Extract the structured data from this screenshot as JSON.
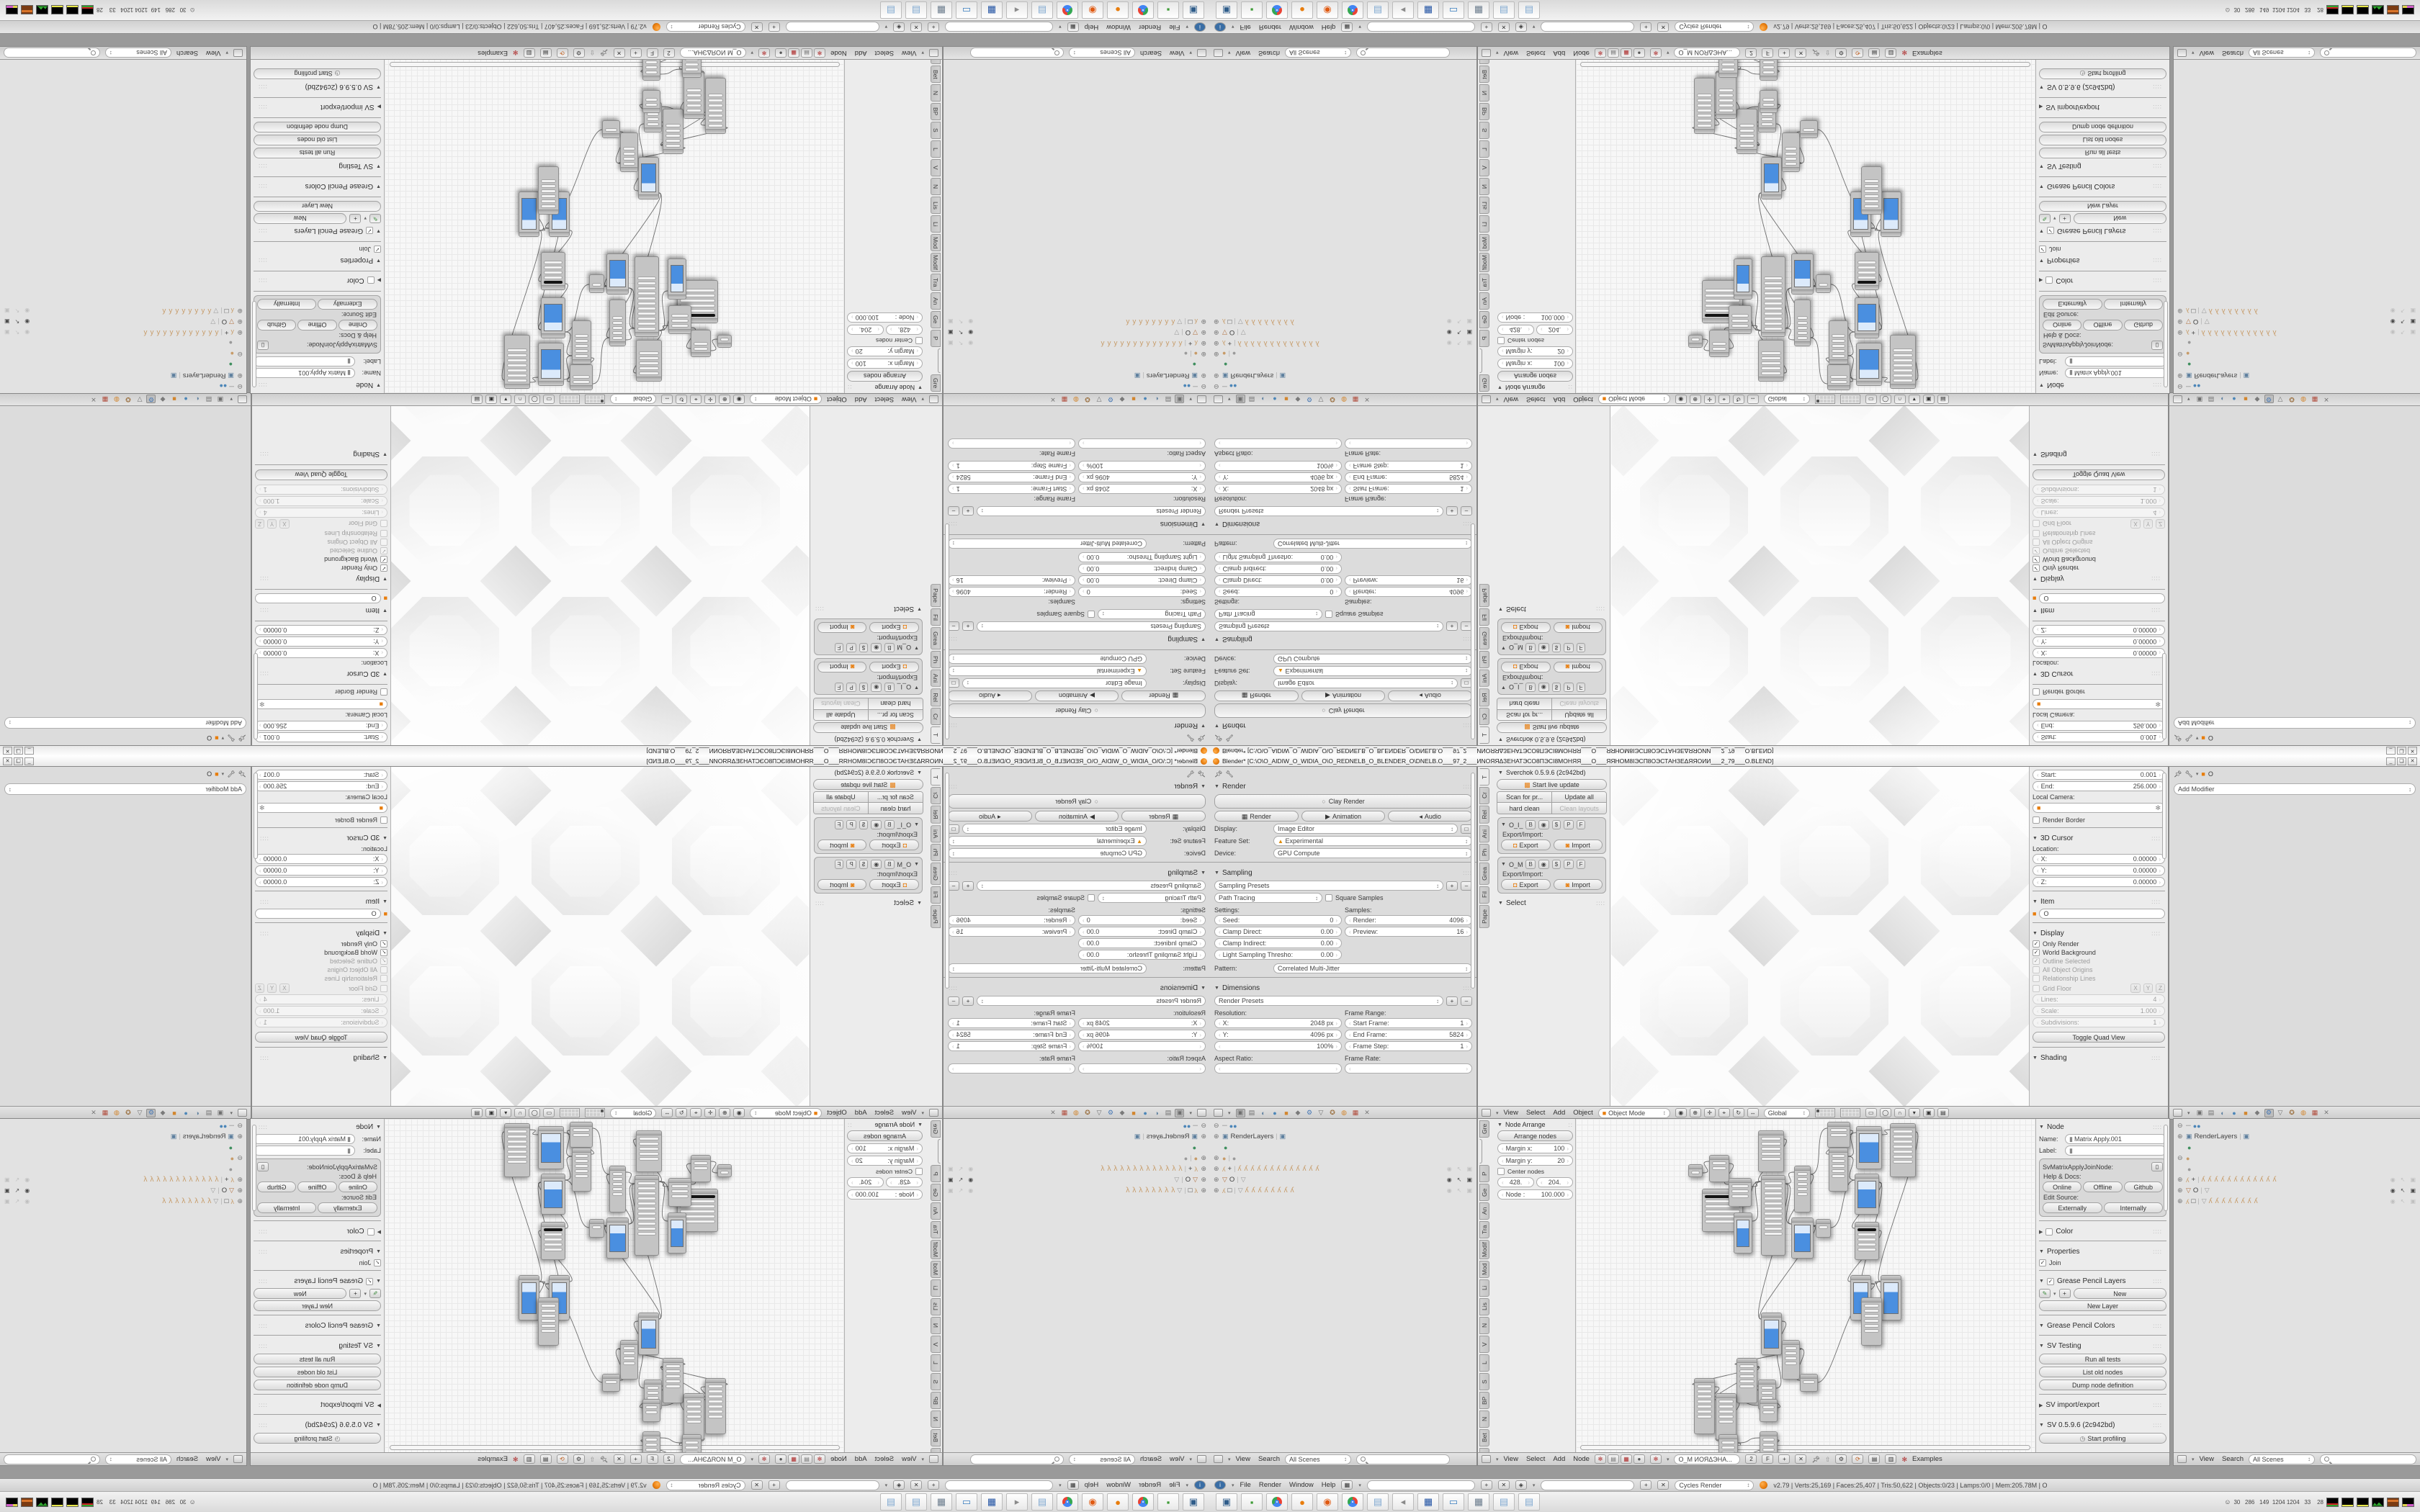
{
  "window": {
    "title": "Blender* [C:\\O\\O_AIDIW_O_WIDIA_O\\O_REDNELB_O_BLENDER_O\\DNELB.O___97_2___ИNOЯЯΔЗЕНАТЭСО8ПЭСІ8МОНЯЯ___O___ЯЯНОМ8ІЭСП8ОЭСТАНЗЕΔЯЯОИИ___2_79___O.BLEND]",
    "controls": {
      "min": "_",
      "restore": "❏",
      "close": "✕"
    }
  },
  "props_render": {
    "panel_render": "Render",
    "clay": "Clay Render",
    "render": "Render",
    "animation": "Animation",
    "audio": "Audio",
    "display_l": "Display:",
    "display_v": "Image Editor",
    "feature_l": "Feature Set:",
    "feature_v": "Experimental",
    "device_l": "Device:",
    "device_v": "GPU Compute",
    "panel_sampling": "Sampling",
    "presets": "Sampling Presets",
    "integrator": "Path Tracing",
    "square": "Square Samples",
    "settings_l": "Settings:",
    "samples_l": "Samples:",
    "seed_l": "Seed:",
    "seed_v": "0",
    "render_s_l": "Render:",
    "render_s_v": "4096",
    "clampd_l": "Clamp Direct:",
    "clampd_v": "0.00",
    "preview_l": "Preview:",
    "preview_v": "16",
    "clampi_l": "Clamp Indirect:",
    "clampi_v": "0.00",
    "light_l": "Light Sampling Thresho:",
    "light_v": "0.00",
    "pattern_l": "Pattern:",
    "pattern_v": "Correlated Multi-Jitter",
    "panel_dim": "Dimensions",
    "dim_presets": "Render Presets",
    "res_l": "Resolution:",
    "frame_l": "Frame Range:",
    "x_l": "X:",
    "x_v": "2048 px",
    "sf_l": "Start Frame:",
    "sf_v": "1",
    "y_l": "Y:",
    "y_v": "4096 px",
    "ef_l": "End Frame:",
    "ef_v": "5824",
    "pct": "100%",
    "fs_l": "Frame Step:",
    "fs_v": "1",
    "aspect_l": "Aspect Ratio:",
    "rate_l": "Frame Rate:"
  },
  "sv_shelf": {
    "tabs": [
      "T",
      "Cr",
      "Rel",
      "Ani",
      "Ph",
      "Grea",
      "Fil",
      "Pape"
    ],
    "title": "Sverchok 0.5.9.6 (2c942bd)",
    "live": "Start live update",
    "grid": [
      "Scan for pr...",
      "Update all",
      "hard clean",
      "Clean layouts"
    ],
    "g1": "O_I_",
    "g2": "O_M",
    "bB": "B",
    "bP": "P",
    "bF": "F",
    "ei": "Export/Import:",
    "exp": "Export",
    "imp": "Import",
    "select": "Select"
  },
  "vp_header": {
    "m1": "View",
    "m2": "Select",
    "m3": "Add",
    "m4": "Object",
    "mode": "Object Mode",
    "orient": "Global",
    "icons": [
      "◉",
      "⊕",
      "✛",
      "⌖",
      "↻",
      "↔"
    ],
    "tail_icons": [
      "▭",
      "◯",
      "∩",
      "▾",
      "▣",
      "▤"
    ]
  },
  "vp_npanel": {
    "start_l": "Start:",
    "start_v": "0.001",
    "end_l": "End:",
    "end_v": "256.000",
    "cam_l": "Local Camera:",
    "border": "Render Border",
    "cursor": "3D Cursor",
    "loc_l": "Location:",
    "x": "X:",
    "xv": "0.00000",
    "y": "Y:",
    "yv": "0.00000",
    "z": "Z:",
    "zv": "0.00000",
    "item": "Item",
    "item_name": "O",
    "display": "Display",
    "only": "Only Render",
    "world": "World Background",
    "outline": "Outline Selected",
    "origins": "All Object Origins",
    "rel": "Relationship Lines",
    "grid": "Grid Floor",
    "gx": "X",
    "gy": "Y",
    "gz": "Z",
    "lines_l": "Lines:",
    "lines_v": "4",
    "scale_l": "Scale:",
    "scale_v": "1.000",
    "subd_l": "Subdivisions:",
    "subd_v": "1",
    "quadview": "Toggle Quad View",
    "shading": "Shading"
  },
  "props_mod": {
    "add": "Add Modifier",
    "crumb": "O"
  },
  "props_tabs": {
    "icons": [
      "▣",
      "▤",
      "◐",
      "●",
      "■",
      "◆",
      "⚙",
      "▽",
      "✪",
      "◍",
      "▦",
      "✕"
    ],
    "colors": [
      "#6f6f6f",
      "#6f6f6f",
      "#5d7f9e",
      "#4c86b8",
      "#d2862e",
      "#7a7a7a",
      "#4a7ab5",
      "#6f6f6f",
      "#9a6f3f",
      "#d2862e",
      "#b04a3a",
      "#7a7a7a"
    ],
    "active_a": 0,
    "active_b": 6
  },
  "outliner": {
    "header": {
      "view": "View",
      "search": "Search",
      "scenes": "All Scenes"
    },
    "a_rows": [
      {
        "type": "root"
      },
      {
        "exp": "⊕",
        "icon": "layers",
        "label": "RenderLayers",
        "extra": "layers"
      },
      {
        "icon": "world",
        "indent": 1
      },
      {
        "exp": "⊕",
        "icon": "blob",
        "extra": "blobg"
      },
      {
        "exp": "⊕",
        "icon": "bone",
        "label": "+",
        "bones": 13,
        "tog": "dim"
      },
      {
        "exp": "⊕",
        "icon": "tri",
        "label": "O",
        "extra": "trig",
        "tog": "on"
      },
      {
        "exp": "⊕",
        "icon": "bone",
        "label": "□",
        "tri": true,
        "bones": 8,
        "tog": "dim"
      }
    ],
    "b_rows": [
      {
        "type": "root"
      },
      {
        "exp": "⊕",
        "icon": "layers",
        "label": "RenderLayers",
        "extra": "layers"
      },
      {
        "icon": "world",
        "indent": 1
      },
      {
        "exp": "⊖",
        "icon": "blob"
      },
      {
        "icon": "blobg",
        "indent": 1
      },
      {
        "exp": "⊕",
        "icon": "bone",
        "label": "+",
        "bones": 12,
        "tog": "dim"
      },
      {
        "exp": "⊕",
        "icon": "tri",
        "label": "O",
        "extra": "trig",
        "tog": "on"
      },
      {
        "exp": "⊕",
        "icon": "bone",
        "label": "□",
        "tri": true,
        "bones": 8,
        "tog": "dim"
      }
    ]
  },
  "node_shelf": {
    "tabs": [
      "Gre",
      "",
      "P",
      "Ge",
      "An",
      "Tra",
      "Modif",
      "Mod",
      "Li",
      "Lis",
      "N",
      "V",
      "L",
      "S",
      "BP",
      "N",
      "Bet",
      "G"
    ],
    "title": "Node Arrange",
    "arrange": "Arrange nodes",
    "mx": "Margin x:",
    "mxv": "100",
    "my": "Margin y:",
    "myv": "20",
    "center": "Center nodes",
    "fa": "428.",
    "fb": "204.",
    "fn_l": "Node :",
    "fn_v": "100.000"
  },
  "node_header": {
    "m1": "View",
    "m2": "Select",
    "m3": "Add",
    "m4": "Node",
    "db": "O_M ИОЯΔЭНА...",
    "users": "2",
    "fake": "F",
    "examples": "Examples"
  },
  "node_npanel": {
    "title": "Node",
    "name_l": "Name:",
    "name_v": "Matrix Apply.001",
    "label_l": "Label:",
    "idname": "SvMatrixApplyJoinNode:",
    "help": "Help & Docs:",
    "h1": "Online",
    "h2": "Offline",
    "h3": "Github",
    "edit": "Edit Source:",
    "e1": "Externally",
    "e2": "Internally",
    "color": "Color",
    "properties": "Properties",
    "join": "Join",
    "gp_layers": "Grease Pencil Layers",
    "new": "New",
    "new_layer": "New Layer",
    "gp_colors": "Grease Pencil Colors",
    "sv_testing": "SV Testing",
    "t1": "Run all tests",
    "t2": "List old nodes",
    "t3": "Dump node definition",
    "sv_ie": "SV import/export",
    "sv_ver": "SV 0.5.9.6 (2c942bd)",
    "profiling": "Start profiling"
  },
  "node_editor": {
    "nodes": [
      [
        156,
        63,
        20,
        18,
        0
      ],
      [
        185,
        50,
        28,
        38,
        0
      ],
      [
        175,
        97,
        57,
        60,
        2
      ],
      [
        212,
        82,
        32,
        40,
        0
      ],
      [
        219,
        130,
        26,
        57,
        1
      ],
      [
        253,
        16,
        36,
        58,
        0
      ],
      [
        257,
        78,
        34,
        112,
        0
      ],
      [
        303,
        65,
        23,
        65,
        0
      ],
      [
        299,
        137,
        31,
        57,
        1
      ],
      [
        333,
        139,
        21,
        26,
        0
      ],
      [
        349,
        4,
        32,
        36,
        0
      ],
      [
        351,
        40,
        27,
        61,
        0
      ],
      [
        389,
        10,
        36,
        60,
        1
      ],
      [
        436,
        6,
        36,
        75,
        0
      ],
      [
        387,
        76,
        34,
        57,
        1
      ],
      [
        387,
        143,
        34,
        53,
        2
      ],
      [
        381,
        217,
        29,
        63,
        1
      ],
      [
        423,
        217,
        29,
        63,
        1
      ],
      [
        396,
        248,
        29,
        67,
        0
      ],
      [
        257,
        269,
        29,
        59,
        1
      ],
      [
        286,
        307,
        25,
        55,
        0
      ],
      [
        311,
        354,
        25,
        25,
        0
      ],
      [
        223,
        332,
        29,
        63,
        0
      ],
      [
        253,
        362,
        25,
        42,
        0
      ],
      [
        164,
        360,
        29,
        78,
        0
      ],
      [
        194,
        381,
        29,
        65,
        0
      ],
      [
        255,
        389,
        25,
        32,
        0
      ],
      [
        198,
        438,
        27,
        42,
        0
      ],
      [
        255,
        434,
        25,
        42,
        0
      ],
      [
        198,
        478,
        27,
        38,
        0
      ],
      [
        255,
        474,
        25,
        40,
        1
      ]
    ],
    "wires": [
      [
        0,
        1
      ],
      [
        1,
        3
      ],
      [
        2,
        6
      ],
      [
        3,
        6
      ],
      [
        4,
        6
      ],
      [
        5,
        6
      ],
      [
        6,
        7
      ],
      [
        6,
        8
      ],
      [
        7,
        8
      ],
      [
        7,
        10
      ],
      [
        10,
        11
      ],
      [
        11,
        12
      ],
      [
        11,
        14
      ],
      [
        13,
        17
      ],
      [
        14,
        15
      ],
      [
        15,
        16
      ],
      [
        16,
        17
      ],
      [
        14,
        18
      ],
      [
        18,
        17
      ],
      [
        8,
        9
      ],
      [
        8,
        19
      ],
      [
        9,
        14
      ],
      [
        19,
        20
      ],
      [
        20,
        21
      ],
      [
        20,
        22
      ],
      [
        22,
        24
      ],
      [
        23,
        20
      ],
      [
        24,
        25
      ],
      [
        25,
        26
      ],
      [
        25,
        27
      ],
      [
        27,
        28
      ],
      [
        27,
        29
      ],
      [
        29,
        30
      ],
      [
        28,
        29
      ],
      [
        26,
        23
      ],
      [
        21,
        18
      ],
      [
        12,
        13
      ],
      [
        6,
        19
      ],
      [
        22,
        25
      ],
      [
        16,
        18
      ]
    ]
  },
  "info": {
    "m1": "File",
    "m2": "Render",
    "m3": "Window",
    "m4": "Help",
    "engine": "Cycles Render",
    "stats": "v2.79 | Verts:25,169 | Faces:25,407 | Tris:50,622 | Objects:0/23 | Lamps:0/0 | Mem:205.78M | O"
  },
  "taskbar": {
    "icons": [
      {
        "name": "remote-desktop",
        "c": "#2f5d8a",
        "g": "▣"
      },
      {
        "name": "green-app",
        "c": "#3d9b35",
        "g": "▪"
      },
      {
        "name": "chrome",
        "c": "chrome",
        "g": ""
      },
      {
        "name": "blender",
        "c": "#e87d0d",
        "g": "●"
      },
      {
        "name": "openshot",
        "c": "#e05a12",
        "g": "◉"
      },
      {
        "name": "chrome",
        "c": "chrome",
        "g": ""
      },
      {
        "name": "notepad",
        "c": "#7fa8d0",
        "g": "▤"
      },
      {
        "name": "speaker",
        "c": "#8a8a8a",
        "g": "◂"
      },
      {
        "name": "fl64-save",
        "c": "#1e50a2",
        "g": "▦"
      },
      {
        "name": "screen-capture",
        "c": "#3a7ebf",
        "g": "▭"
      },
      {
        "name": "calculator",
        "c": "#6a7b8c",
        "g": "▦"
      },
      {
        "name": "notepad",
        "c": "#7fa8d0",
        "g": "▤"
      },
      {
        "name": "notepad",
        "c": "#7fa8d0",
        "g": "▤"
      }
    ],
    "tray_numbers": "30   286   149  1204 1204   33    28"
  },
  "colors": {
    "accent_blue": "#4a8fe0",
    "blender_orange": "#e87d0d",
    "select_tan": "#c79b68"
  }
}
